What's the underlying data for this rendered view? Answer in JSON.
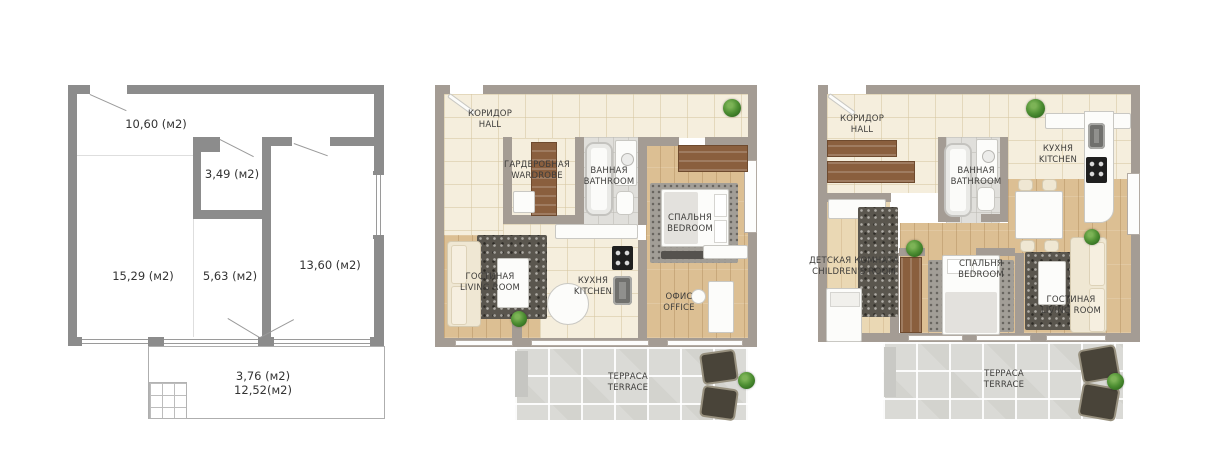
{
  "plans": {
    "schematic": {
      "areas": {
        "hall": "10,60 (м2)",
        "wardrobe": "3,49 (м2)",
        "living": "15,29 (м2)",
        "kitchen": "5,63 (м2)",
        "bedroom": "13,60 (м2)",
        "terrace_half": "3,76 (м2)",
        "terrace_full": "12,52(м2)"
      }
    },
    "plan_a": {
      "rooms": {
        "hall": {
          "ru": "КОРИДОР",
          "en": "HALL"
        },
        "wardrobe": {
          "ru": "ГАРДЕРОБНАЯ",
          "en": "WARDROBE"
        },
        "bathroom": {
          "ru": "ВАННАЯ",
          "en": "BATHROOM"
        },
        "bedroom": {
          "ru": "СПАЛЬНЯ",
          "en": "BEDROOM"
        },
        "living": {
          "ru": "ГОСТИНАЯ",
          "en": "LIVING ROOM"
        },
        "kitchen": {
          "ru": "КУХНЯ",
          "en": "KITCHEN"
        },
        "office": {
          "ru": "ОФИС",
          "en": "OFFICE"
        },
        "terrace": {
          "ru": "ТЕРРАСА",
          "en": "TERRACE"
        }
      }
    },
    "plan_b": {
      "rooms": {
        "hall": {
          "ru": "КОРИДОР",
          "en": "HALL"
        },
        "bathroom": {
          "ru": "ВАННАЯ",
          "en": "BATHROOM"
        },
        "kitchen": {
          "ru": "КУХНЯ",
          "en": "KITCHEN"
        },
        "children": {
          "ru": "ДЕТСКАЯ КОМНАТА",
          "en": "CHILDREN'S ROOM"
        },
        "bedroom": {
          "ru": "СПАЛЬНЯ",
          "en": "BEDROOM"
        },
        "living": {
          "ru": "ГОСТИНАЯ",
          "en": "LIVING ROOM"
        },
        "terrace": {
          "ru": "ТЕРРАСА",
          "en": "TERRACE"
        }
      }
    },
    "colors": {
      "wall_rendered": "#a49c94",
      "wall_schematic": "#8c8c8c",
      "tile_floor": "#f5eedd",
      "wood_floor": "#dcbf93",
      "terrace_floor": "#dadad6",
      "plant_green": "#4e8f33"
    }
  }
}
